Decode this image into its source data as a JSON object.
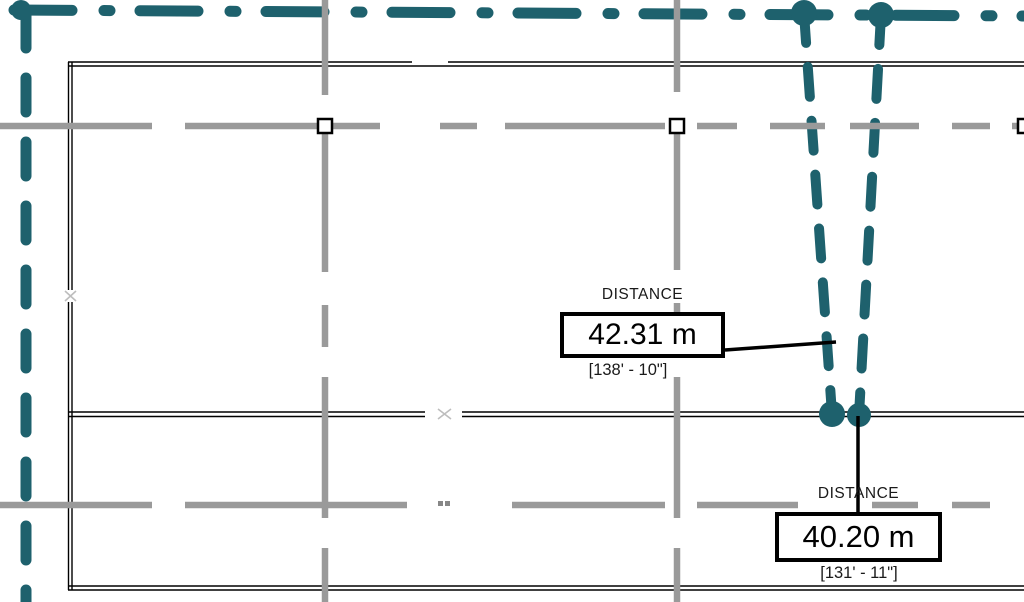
{
  "view": {
    "title": "Plan view with travel distance tags"
  },
  "tags": [
    {
      "label": "DISTANCE",
      "value": "42.31 m",
      "imperial": "[138' - 10\"]"
    },
    {
      "label": "DISTANCE",
      "value": "40.20 m",
      "imperial": "[131' - 11\"]"
    }
  ],
  "colors": {
    "travel_path_teal": "#1e616d",
    "grid_gray": "#9a9a9a",
    "wall_black": "#000000",
    "tag_border": "#000000",
    "background": "#ffffff"
  },
  "icons": {
    "grid_anchor": "square-anchor-icon",
    "path_endpoint": "filled-circle-icon"
  }
}
